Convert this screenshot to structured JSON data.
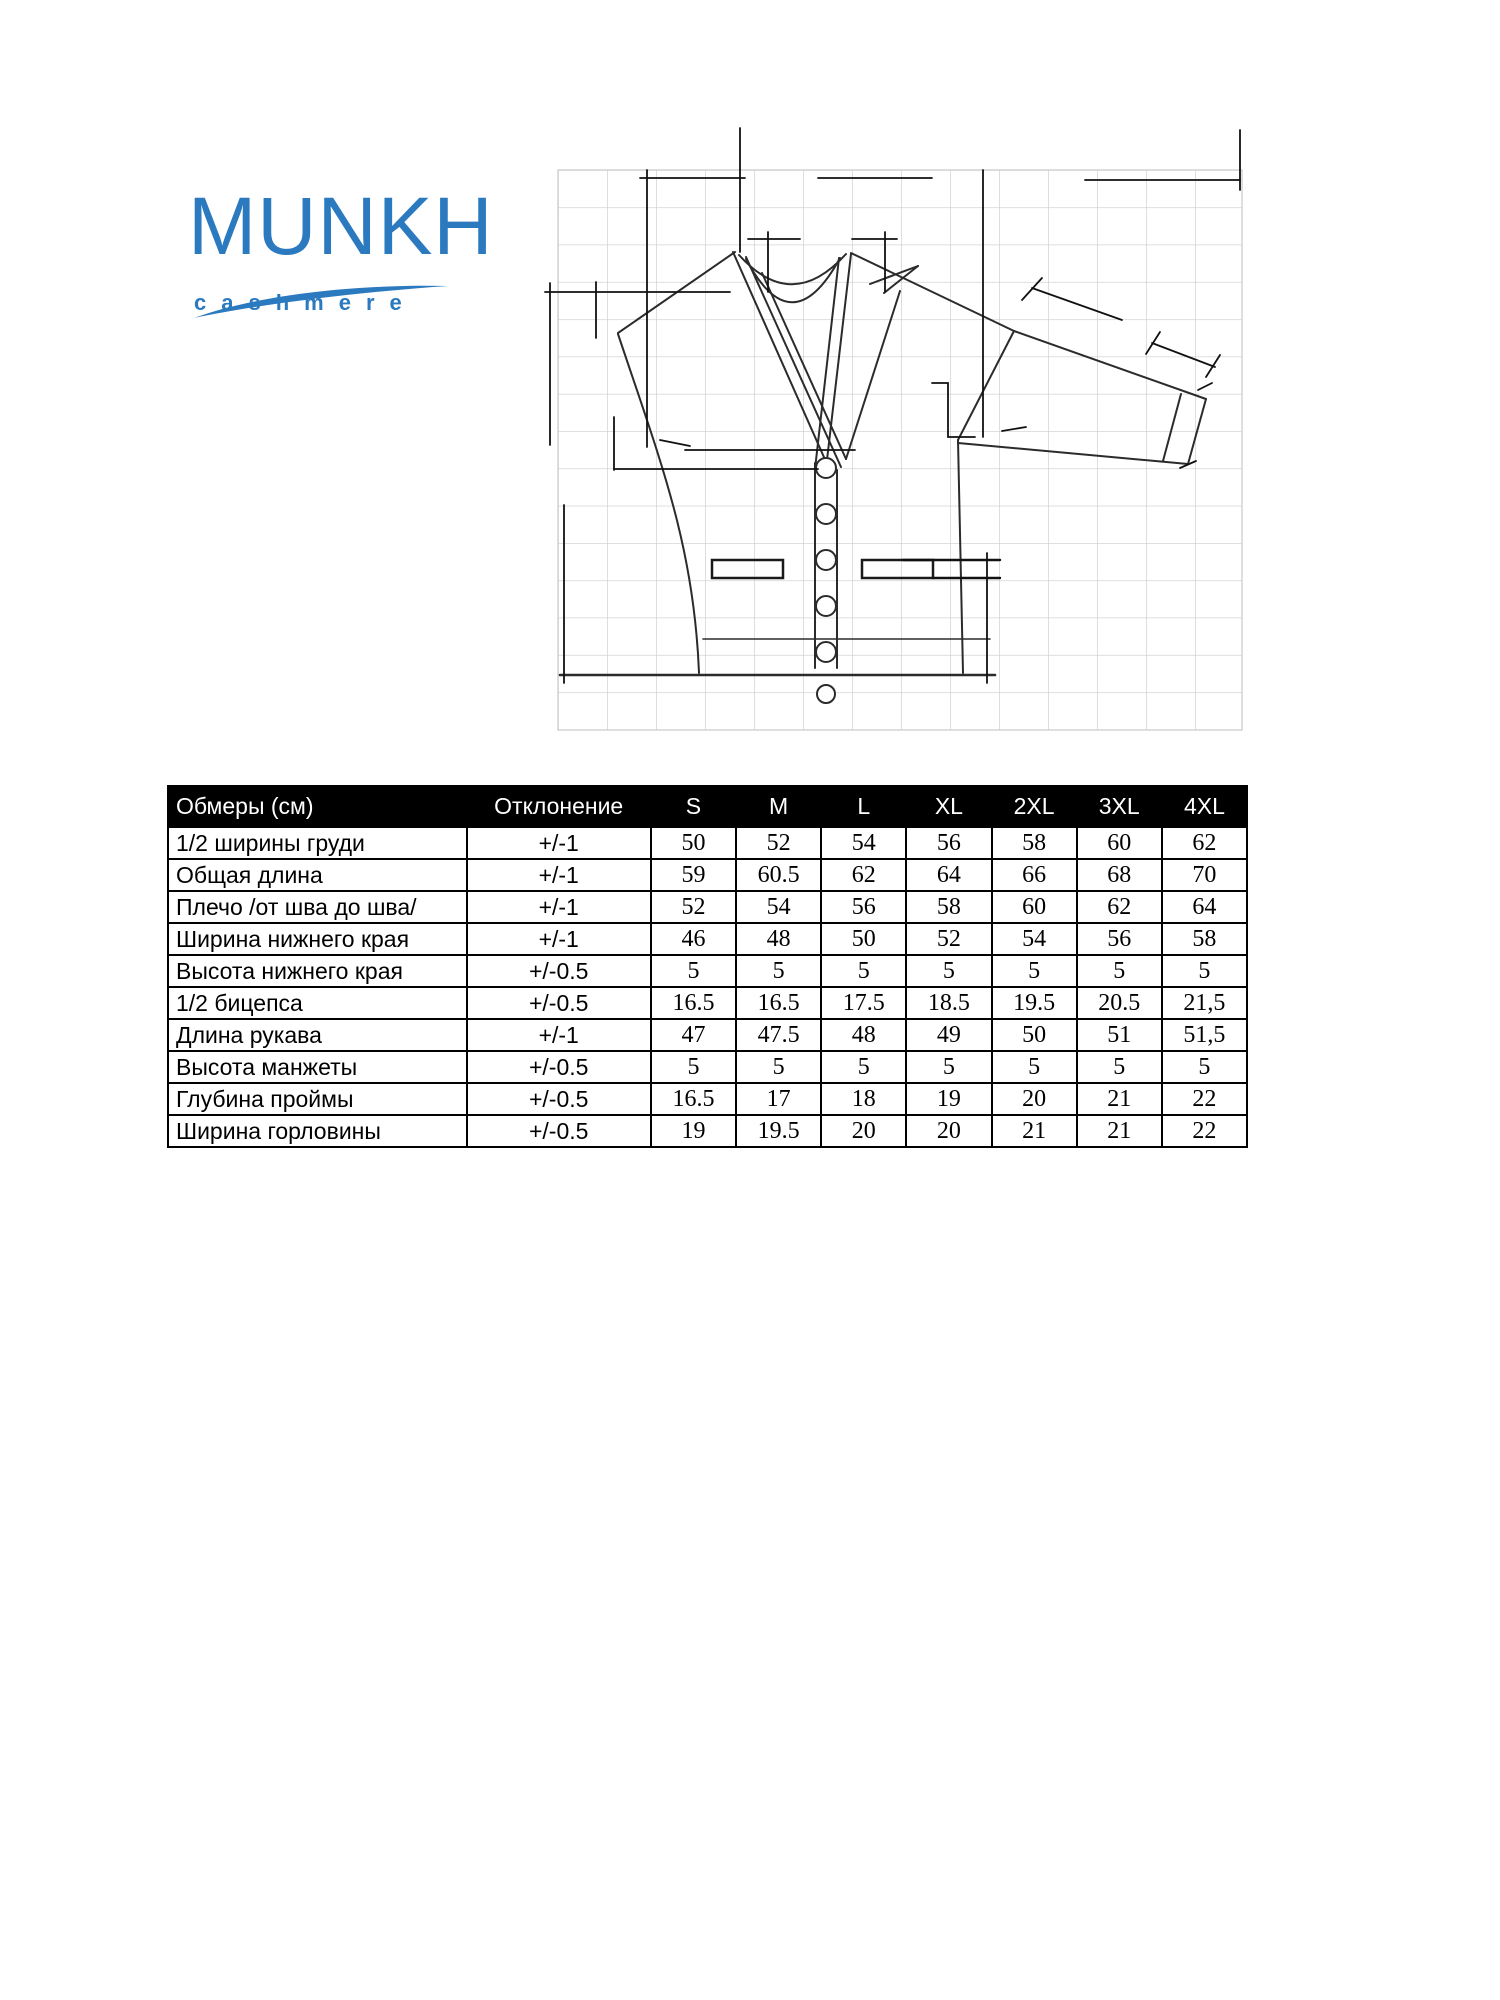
{
  "logo": {
    "brand": "MUNKH",
    "subbrand": "cashmere",
    "color": "#2b7abf"
  },
  "drawing": {
    "grid_color": "#cccccc",
    "line_color": "#2b2b2b",
    "dimension_color": "#111111"
  },
  "table": {
    "header_bg": "#000000",
    "header_fg": "#ffffff",
    "header": {
      "measure": "Обмеры (см)",
      "deviation": "Отклонение",
      "sizes": [
        "S",
        "M",
        "L",
        "XL",
        "2XL",
        "3XL",
        "4XL"
      ]
    },
    "rows": [
      {
        "label": "1/2 ширины груди",
        "deviation": "+/-1",
        "values": [
          "50",
          "52",
          "54",
          "56",
          "58",
          "60",
          "62"
        ]
      },
      {
        "label": "Общая длина",
        "deviation": "+/-1",
        "values": [
          "59",
          "60.5",
          "62",
          "64",
          "66",
          "68",
          "70"
        ]
      },
      {
        "label": "Плечо /от шва до шва/",
        "deviation": "+/-1",
        "values": [
          "52",
          "54",
          "56",
          "58",
          "60",
          "62",
          "64"
        ]
      },
      {
        "label": "Ширина нижнего края",
        "deviation": "+/-1",
        "values": [
          "46",
          "48",
          "50",
          "52",
          "54",
          "56",
          "58"
        ]
      },
      {
        "label": "Высота нижнего края",
        "deviation": "+/-0.5",
        "values": [
          "5",
          "5",
          "5",
          "5",
          "5",
          "5",
          "5"
        ]
      },
      {
        "label": "1/2 бицепса",
        "deviation": "+/-0.5",
        "values": [
          "16.5",
          "16.5",
          "17.5",
          "18.5",
          "19.5",
          "20.5",
          "21,5"
        ]
      },
      {
        "label": "Длина рукава",
        "deviation": "+/-1",
        "values": [
          "47",
          "47.5",
          "48",
          "49",
          "50",
          "51",
          "51,5"
        ]
      },
      {
        "label": "Высота манжеты",
        "deviation": "+/-0.5",
        "values": [
          "5",
          "5",
          "5",
          "5",
          "5",
          "5",
          "5"
        ]
      },
      {
        "label": "Глубина проймы",
        "deviation": "+/-0.5",
        "values": [
          "16.5",
          "17",
          "18",
          "19",
          "20",
          "21",
          "22"
        ]
      },
      {
        "label": "Ширина горловины",
        "deviation": "+/-0.5",
        "values": [
          "19",
          "19.5",
          "20",
          "20",
          "21",
          "21",
          "22"
        ]
      }
    ]
  }
}
